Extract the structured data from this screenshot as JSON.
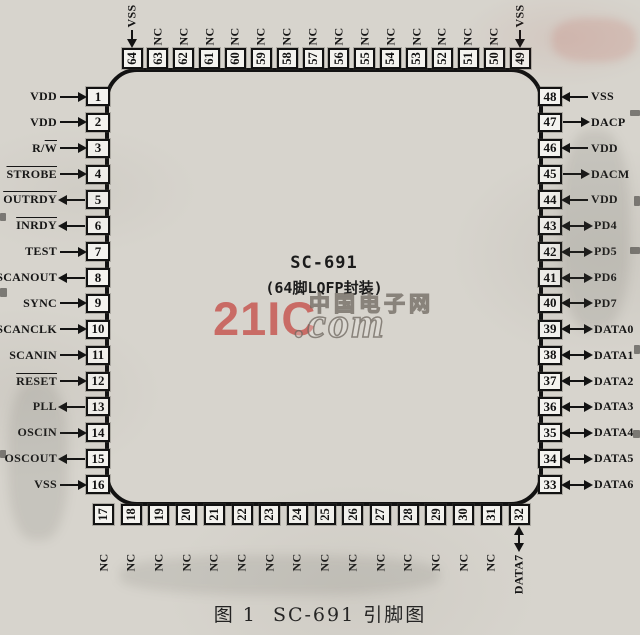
{
  "figure": {
    "chip_name": "SC-691",
    "package_label": "(64脚LQFP封装)",
    "caption": "图 1  SC-691 引脚图"
  },
  "watermark": {
    "brand": "21IC",
    "com": ".com",
    "site": "中国电子网",
    "brand_color": "#c6544e",
    "outline_color": "#6c665d"
  },
  "colors": {
    "paper": "#d7d4cd",
    "ink": "#121212",
    "pin_box_fill": "#f4f3ef"
  },
  "pins": {
    "left": [
      {
        "num": "1",
        "plain": "VDD",
        "over": "",
        "dir": "in"
      },
      {
        "num": "2",
        "plain": "VDD",
        "over": "",
        "dir": "in"
      },
      {
        "num": "3",
        "plain": "R/",
        "over": "W",
        "dir": "in"
      },
      {
        "num": "4",
        "plain": "",
        "over": "STROBE",
        "dir": "in"
      },
      {
        "num": "5",
        "plain": "",
        "over": "OUTRDY",
        "dir": "out"
      },
      {
        "num": "6",
        "plain": "",
        "over": "INRDY",
        "dir": "out"
      },
      {
        "num": "7",
        "plain": "TEST",
        "over": "",
        "dir": "in"
      },
      {
        "num": "8",
        "plain": "SCANOUT",
        "over": "",
        "dir": "out"
      },
      {
        "num": "9",
        "plain": "SYNC",
        "over": "",
        "dir": "in"
      },
      {
        "num": "10",
        "plain": "SCANCLK",
        "over": "",
        "dir": "in"
      },
      {
        "num": "11",
        "plain": "SCANIN",
        "over": "",
        "dir": "in"
      },
      {
        "num": "12",
        "plain": "",
        "over": "RESET",
        "dir": "in"
      },
      {
        "num": "13",
        "plain": "PLL",
        "over": "",
        "dir": "out"
      },
      {
        "num": "14",
        "plain": "OSCIN",
        "over": "",
        "dir": "in"
      },
      {
        "num": "15",
        "plain": "OSCOUT",
        "over": "",
        "dir": "out"
      },
      {
        "num": "16",
        "plain": "VSS",
        "over": "",
        "dir": "in"
      }
    ],
    "right": [
      {
        "num": "48",
        "plain": "VSS",
        "over": "",
        "dir": "in"
      },
      {
        "num": "47",
        "plain": "DACP",
        "over": "",
        "dir": "out"
      },
      {
        "num": "46",
        "plain": "VDD",
        "over": "",
        "dir": "in"
      },
      {
        "num": "45",
        "plain": "DACM",
        "over": "",
        "dir": "out"
      },
      {
        "num": "44",
        "plain": "VDD",
        "over": "",
        "dir": "in"
      },
      {
        "num": "43",
        "plain": "PD4",
        "over": "",
        "dir": "bi"
      },
      {
        "num": "42",
        "plain": "PD5",
        "over": "",
        "dir": "bi"
      },
      {
        "num": "41",
        "plain": "PD6",
        "over": "",
        "dir": "bi"
      },
      {
        "num": "40",
        "plain": "PD7",
        "over": "",
        "dir": "bi"
      },
      {
        "num": "39",
        "plain": "DATA0",
        "over": "",
        "dir": "bi"
      },
      {
        "num": "38",
        "plain": "DATA1",
        "over": "",
        "dir": "bi"
      },
      {
        "num": "37",
        "plain": "DATA2",
        "over": "",
        "dir": "bi"
      },
      {
        "num": "36",
        "plain": "DATA3",
        "over": "",
        "dir": "bi"
      },
      {
        "num": "35",
        "plain": "DATA4",
        "over": "",
        "dir": "bi"
      },
      {
        "num": "34",
        "plain": "DATA5",
        "over": "",
        "dir": "bi"
      },
      {
        "num": "33",
        "plain": "DATA6",
        "over": "",
        "dir": "bi"
      }
    ],
    "top": [
      {
        "num": "64",
        "plain": "VSS",
        "over": "",
        "dir": "in"
      },
      {
        "num": "63",
        "plain": "NC",
        "over": "",
        "dir": "none"
      },
      {
        "num": "62",
        "plain": "NC",
        "over": "",
        "dir": "none"
      },
      {
        "num": "61",
        "plain": "NC",
        "over": "",
        "dir": "none"
      },
      {
        "num": "60",
        "plain": "NC",
        "over": "",
        "dir": "none"
      },
      {
        "num": "59",
        "plain": "NC",
        "over": "",
        "dir": "none"
      },
      {
        "num": "58",
        "plain": "NC",
        "over": "",
        "dir": "none"
      },
      {
        "num": "57",
        "plain": "NC",
        "over": "",
        "dir": "none"
      },
      {
        "num": "56",
        "plain": "NC",
        "over": "",
        "dir": "none"
      },
      {
        "num": "55",
        "plain": "NC",
        "over": "",
        "dir": "none"
      },
      {
        "num": "54",
        "plain": "NC",
        "over": "",
        "dir": "none"
      },
      {
        "num": "53",
        "plain": "NC",
        "over": "",
        "dir": "none"
      },
      {
        "num": "52",
        "plain": "NC",
        "over": "",
        "dir": "none"
      },
      {
        "num": "51",
        "plain": "NC",
        "over": "",
        "dir": "none"
      },
      {
        "num": "50",
        "plain": "NC",
        "over": "",
        "dir": "none"
      },
      {
        "num": "49",
        "plain": "VSS",
        "over": "",
        "dir": "in"
      }
    ],
    "bottom": [
      {
        "num": "17",
        "plain": "NC",
        "over": "",
        "dir": "none"
      },
      {
        "num": "18",
        "plain": "NC",
        "over": "",
        "dir": "none"
      },
      {
        "num": "19",
        "plain": "NC",
        "over": "",
        "dir": "none"
      },
      {
        "num": "20",
        "plain": "NC",
        "over": "",
        "dir": "none"
      },
      {
        "num": "21",
        "plain": "NC",
        "over": "",
        "dir": "none"
      },
      {
        "num": "22",
        "plain": "NC",
        "over": "",
        "dir": "none"
      },
      {
        "num": "23",
        "plain": "NC",
        "over": "",
        "dir": "none"
      },
      {
        "num": "24",
        "plain": "NC",
        "over": "",
        "dir": "none"
      },
      {
        "num": "25",
        "plain": "NC",
        "over": "",
        "dir": "none"
      },
      {
        "num": "26",
        "plain": "NC",
        "over": "",
        "dir": "none"
      },
      {
        "num": "27",
        "plain": "NC",
        "over": "",
        "dir": "none"
      },
      {
        "num": "28",
        "plain": "NC",
        "over": "",
        "dir": "none"
      },
      {
        "num": "29",
        "plain": "NC",
        "over": "",
        "dir": "none"
      },
      {
        "num": "30",
        "plain": "NC",
        "over": "",
        "dir": "none"
      },
      {
        "num": "31",
        "plain": "NC",
        "over": "",
        "dir": "none"
      },
      {
        "num": "32",
        "plain": "DATA7",
        "over": "",
        "dir": "bi"
      }
    ]
  }
}
